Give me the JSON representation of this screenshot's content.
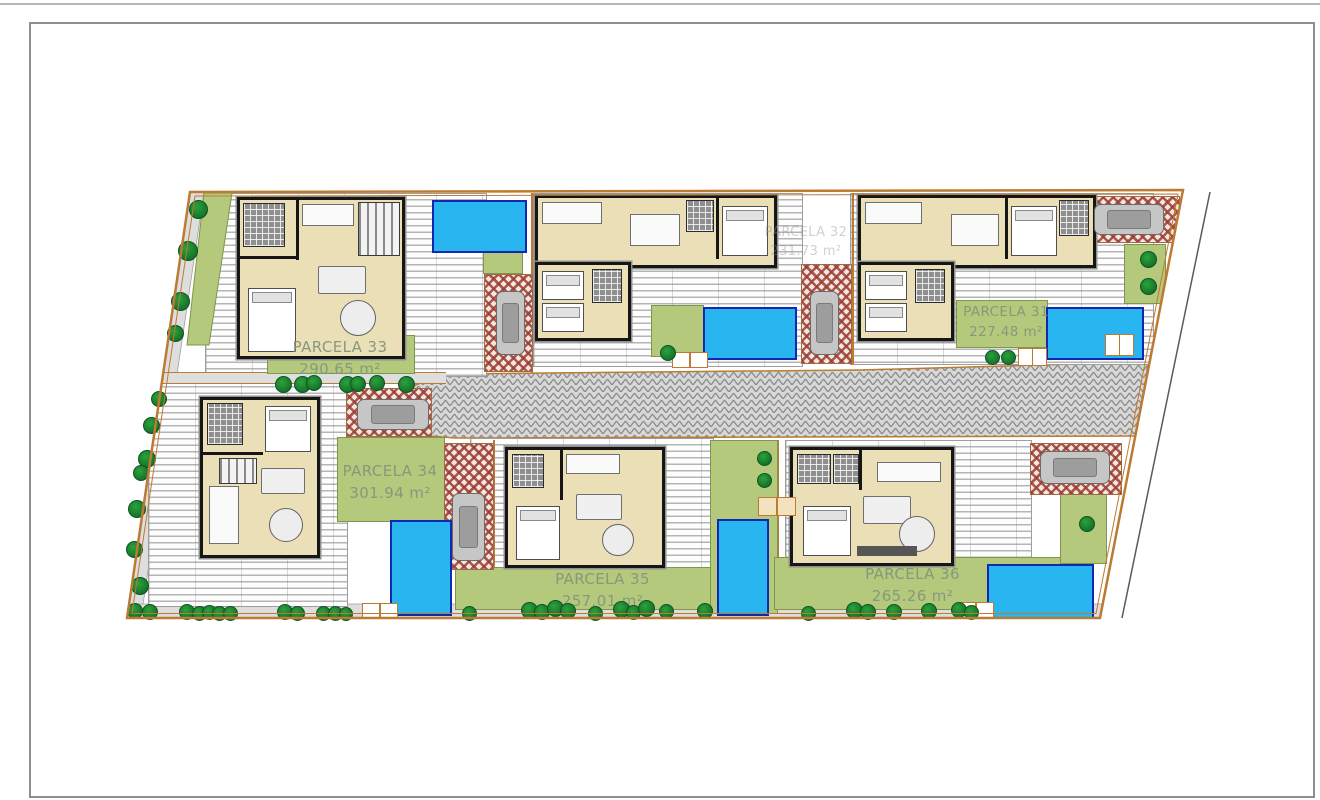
{
  "sheet": {
    "type": "architectural site plan",
    "description": "Top-view site plan of six single-family villa plots with pools, decks, gardens and a central paved street"
  },
  "parcels": {
    "p31": {
      "name": "PARCELA 31",
      "area": "227.48 m²"
    },
    "p32": {
      "name": "PARCELA 32",
      "area": "231.73 m²"
    },
    "p33": {
      "name": "PARCELA 33",
      "area": "290.65 m²"
    },
    "p34": {
      "name": "PARCELA 34",
      "area": "301.94 m²"
    },
    "p35": {
      "name": "PARCELA 35",
      "area": "257.01 m²"
    },
    "p36": {
      "name": "PARCELA 36",
      "area": "265.26 m²"
    }
  },
  "colors": {
    "pool": "#29b6f0",
    "pool_border": "#1228b0",
    "lawn": "#b4c97b",
    "tree": "#15712a",
    "drive_red": "#9c3c32",
    "road_gray": "#8e8e8e",
    "boundary": "#bd7a32",
    "floor": "#ebdfb8",
    "wall": "#161616"
  }
}
